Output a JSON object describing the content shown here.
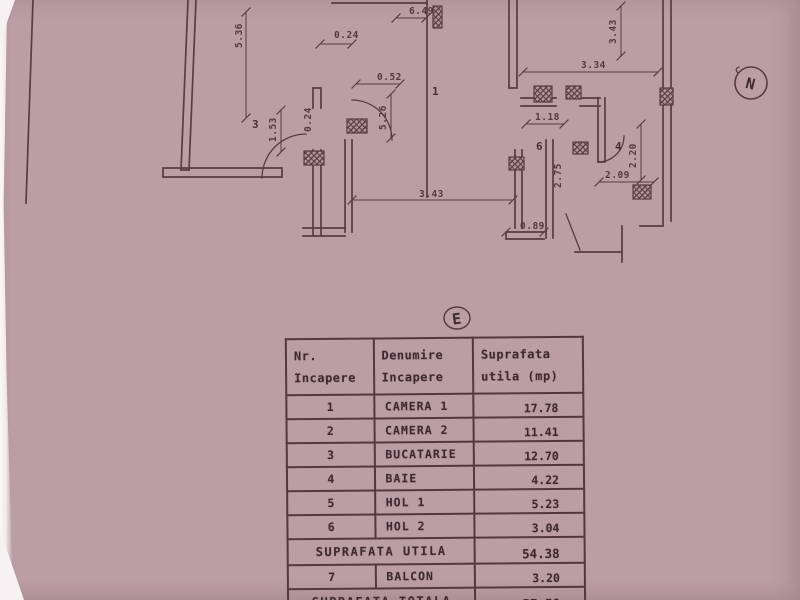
{
  "paper_color": "#bb9da5",
  "ink_color": "#4a3238",
  "plan": {
    "north_marker": "N",
    "section_marker": "E",
    "room_labels": [
      {
        "text": "3",
        "x": 252,
        "y": 128
      },
      {
        "text": "1",
        "x": 432,
        "y": 95
      },
      {
        "text": "6",
        "x": 536,
        "y": 150
      },
      {
        "text": "4",
        "x": 615,
        "y": 150
      }
    ],
    "dimension_labels": [
      {
        "text": "5.36",
        "x": 242,
        "y": 48,
        "rot": true
      },
      {
        "text": "1.53",
        "x": 276,
        "y": 142,
        "rot": true
      },
      {
        "text": "0.24",
        "x": 334,
        "y": 38,
        "rot": false
      },
      {
        "text": "0.24",
        "x": 311,
        "y": 132,
        "rot": true
      },
      {
        "text": "6.49",
        "x": 409,
        "y": 14,
        "rot": false
      },
      {
        "text": "0.52",
        "x": 377,
        "y": 80,
        "rot": false
      },
      {
        "text": "5.26",
        "x": 386,
        "y": 130,
        "rot": true
      },
      {
        "text": "3.43",
        "x": 616,
        "y": 44,
        "rot": true
      },
      {
        "text": "3.34",
        "x": 581,
        "y": 68,
        "rot": false
      },
      {
        "text": "1.18",
        "x": 535,
        "y": 120,
        "rot": false
      },
      {
        "text": "2.20",
        "x": 636,
        "y": 168,
        "rot": true
      },
      {
        "text": "2.09",
        "x": 605,
        "y": 178,
        "rot": false
      },
      {
        "text": "2.75",
        "x": 561,
        "y": 188,
        "rot": true
      },
      {
        "text": "3.43",
        "x": 419,
        "y": 197,
        "rot": false
      },
      {
        "text": "0.89",
        "x": 520,
        "y": 229,
        "rot": false
      }
    ]
  },
  "table": {
    "headers": [
      {
        "line1": "Nr.",
        "line2": "Incapere"
      },
      {
        "line1": "Denumire",
        "line2": "Incapere"
      },
      {
        "line1": "Suprafata",
        "line2": "utila (mp)"
      }
    ],
    "rows": [
      {
        "type": "data",
        "nr": "1",
        "name": "CAMERA 1",
        "area": "17.78"
      },
      {
        "type": "data",
        "nr": "2",
        "name": "CAMERA 2",
        "area": "11.41"
      },
      {
        "type": "data",
        "nr": "3",
        "name": "BUCATARIE",
        "area": "12.70"
      },
      {
        "type": "data",
        "nr": "4",
        "name": "BAIE",
        "area": "4.22"
      },
      {
        "type": "data",
        "nr": "5",
        "name": "HOL 1",
        "area": "5.23"
      },
      {
        "type": "data",
        "nr": "6",
        "name": "HOL 2",
        "area": "3.04"
      },
      {
        "type": "summary",
        "label": "SUPRAFATA UTILA",
        "area": "54.38"
      },
      {
        "type": "data",
        "nr": "7",
        "name": "BALCON",
        "area": "3.20"
      },
      {
        "type": "summary",
        "label": "SUPRAFATA TOTALA",
        "area": "57.58"
      }
    ]
  }
}
